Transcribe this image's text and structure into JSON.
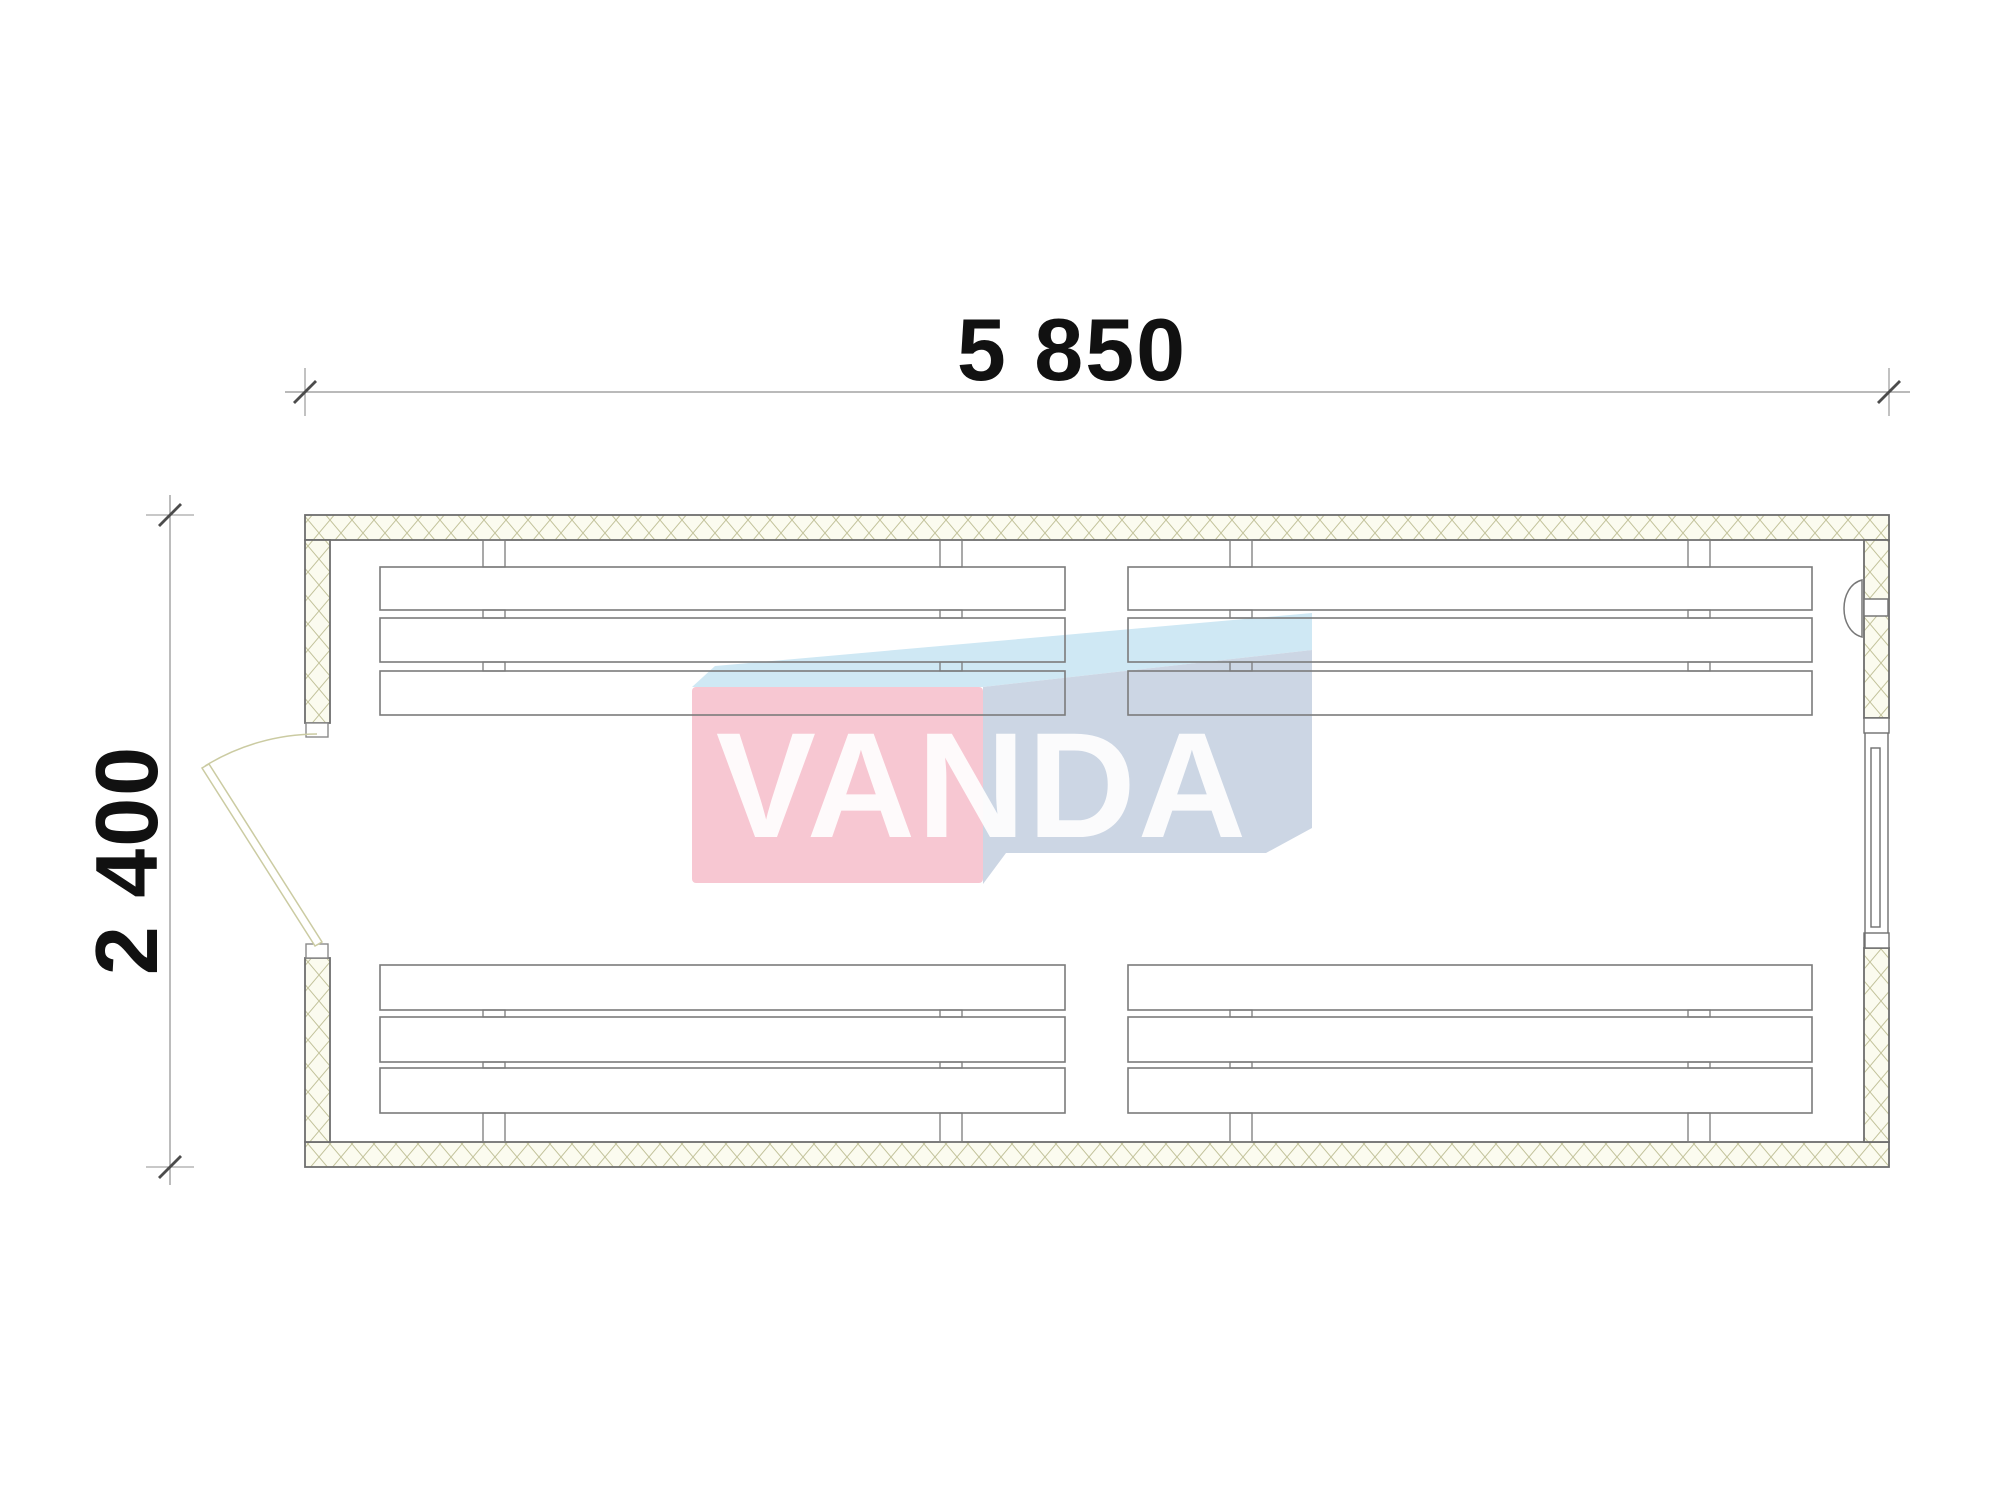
{
  "drawing": {
    "type": "floor-plan",
    "dimensions": {
      "width_label": "5 850",
      "height_label": "2 400"
    },
    "walls": {
      "hatch_line_color": "#c2c29a",
      "fill_color": "#fbfbef",
      "border_color": "#6e6e6e"
    },
    "furniture": {
      "bench_groups": 4,
      "slats_per_bench": 3,
      "line_color": "#7b7b7b"
    },
    "door": {
      "line_color": "#cbcba2"
    },
    "window": {
      "line_color": "#6f6f6f"
    },
    "dimension_style": {
      "line_color": "#909090",
      "tick_color": "#4c4c4c",
      "text_color": "#111111"
    }
  },
  "watermark": {
    "text": "VANDA",
    "colors": {
      "front": "#f7c7d2",
      "top": "#cfe8f4",
      "side": "#ccd6e4",
      "text": "#ffffff"
    }
  }
}
